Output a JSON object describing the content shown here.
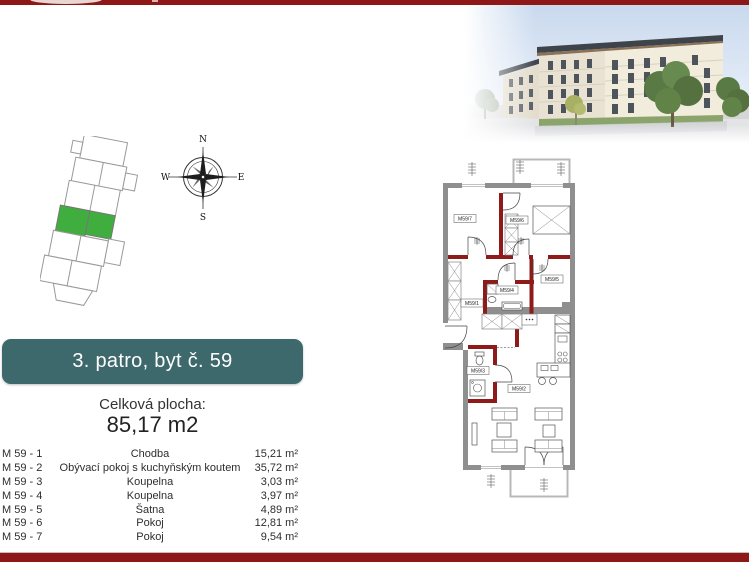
{
  "colors": {
    "red": "#8e1818",
    "teal": "#3d686c",
    "green": "#3fae3f",
    "plan_red": "#8e1a1a",
    "wall_gray": "#8f8f8f"
  },
  "banner": {
    "text": "3. patro, byt č. 59"
  },
  "area": {
    "label": "Celková plocha:",
    "value": "85,17 m2"
  },
  "compass": {
    "n": "N",
    "e": "E",
    "s": "S",
    "w": "W"
  },
  "rooms": [
    {
      "code": "M 59 - 1",
      "name": "Chodba",
      "area": "15,21 m²"
    },
    {
      "code": "M 59 - 2",
      "name": "Obývací pokoj s kuchyňským koutem",
      "area": "35,72 m²"
    },
    {
      "code": "M 59 - 3",
      "name": "Koupelna",
      "area": "3,03 m²"
    },
    {
      "code": "M 59 - 4",
      "name": "Koupelna",
      "area": "3,97 m²"
    },
    {
      "code": "M 59 - 5",
      "name": "Šatna",
      "area": "4,89 m²"
    },
    {
      "code": "M 59 - 6",
      "name": "Pokoj",
      "area": "12,81 m²"
    },
    {
      "code": "M 59 - 7",
      "name": "Pokoj",
      "area": "9,54 m²"
    }
  ],
  "plan": {
    "labels": [
      {
        "text": "M59/7"
      },
      {
        "text": "M59/6"
      },
      {
        "text": "M59/5"
      },
      {
        "text": "M59/4"
      },
      {
        "text": "M59/1"
      },
      {
        "text": "M59/3"
      },
      {
        "text": "M59/2"
      }
    ]
  }
}
